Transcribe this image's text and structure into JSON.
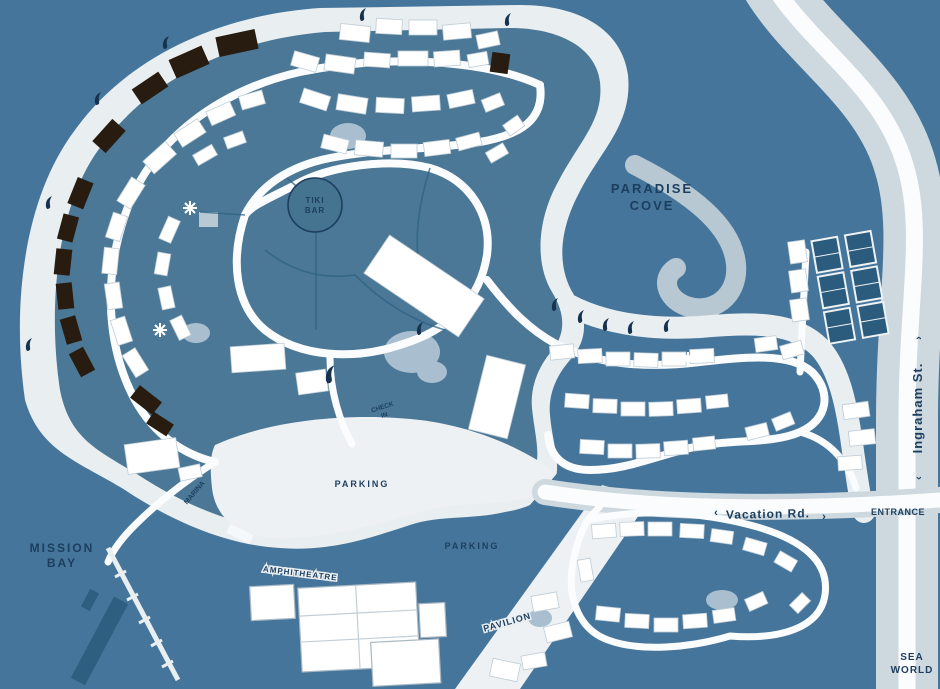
{
  "map": {
    "title": "bay resort illustrated map",
    "labels": {
      "paradise_cove_line1": "PARADISE",
      "paradise_cove_line2": "COVE",
      "mission_bay_line1": "MISSION",
      "mission_bay_line2": "BAY",
      "ingraham_st": "Ingraham St.",
      "vacation_rd": "Vacation Rd.",
      "entrance": "ENTRANCE",
      "parking_west": "PARKING",
      "parking_south": "PARKING",
      "sea_world_line1": "SEA",
      "sea_world_line2": "WORLD",
      "amphitheatre": "AMPHITHEATRE",
      "pavilion": "PAVILION",
      "tiki_line1": "TIKI",
      "tiki_line2": "BAR",
      "marina": "MARINA",
      "check_in_line1": "CHECK",
      "check_in_line2": "IN",
      "arrow_left": "‹",
      "arrow_right": "›"
    },
    "colors": {
      "water": "#45759B",
      "sand": "#E9EEF1",
      "interior_land": "#4A7896",
      "road": "#FBFCFD",
      "street_band": "#C9D4DC",
      "pond": "#A9BFCF",
      "building": "#FFFFFF",
      "dark_building": "#281C11",
      "tennis_court": "#2B5B7D",
      "label_navy": "#1C3E5F"
    }
  }
}
